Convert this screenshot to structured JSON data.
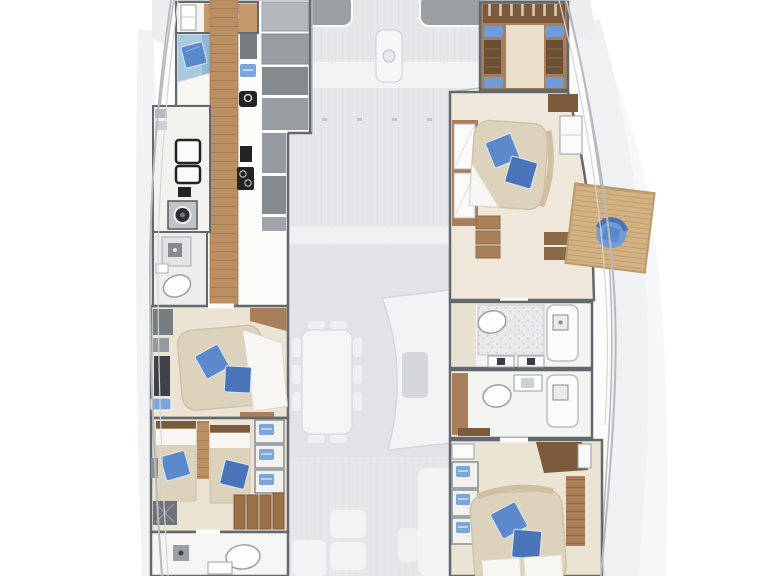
{
  "meta": {
    "subject": "catamaran-yacht-floor-plan",
    "view": "top-down",
    "decks": [
      "lower-deck-accommodation",
      "main-deck-faded-underlay"
    ],
    "visible_text": ""
  },
  "palette": {
    "wall": "#63686c",
    "hull": "#b6babe",
    "wood": "#b98f63",
    "wood_mid": "#a87f58",
    "wood_dark": "#7c5a3c",
    "wood_light": "#c59a6d",
    "platform": "#d2b183",
    "floor": "#ebe3d3",
    "floor_light": "#f0ece4",
    "mattress": "#ddd2bc",
    "linen": "#f7f6f3",
    "bed_blue": "#a9cade",
    "pillow": "#5c88cc",
    "pillow_dark": "#4a74b8",
    "cushion": "#6f9bd9",
    "item_blue": "#7aa6d8",
    "grey_cab": "#94999d",
    "grey_dark": "#787d81",
    "black": "#232323",
    "deck": "#e6e7e9",
    "deck_shape": "#f4f5f6",
    "deck_line": "#d5d7da",
    "hatch": "#8f9499",
    "white": "#ffffff"
  },
  "rooms": {
    "port_hull": [
      {
        "id": "port-fore-bathroom",
        "furniture": [
          "toilet",
          "cabinet",
          "wood-floor"
        ]
      },
      {
        "id": "port-fore-cabin",
        "furniture": [
          "single-bed-lightblue",
          "blue-pillow",
          "white-linen"
        ]
      },
      {
        "id": "port-corridor",
        "furniture": [
          "wood-plank-floor"
        ]
      },
      {
        "id": "port-galley",
        "furniture": [
          "fridge",
          "washing-machine",
          "sink",
          "stove",
          "counters",
          "cabinets",
          "blue-towel"
        ]
      },
      {
        "id": "port-mid-bathroom",
        "furniture": [
          "shower",
          "toilet",
          "washbasin"
        ]
      },
      {
        "id": "port-mid-cabin",
        "furniture": [
          "double-bed",
          "blue-pillow",
          "blue-pillow",
          "desk",
          "blue-washbasin",
          "wood-trim",
          "bench"
        ]
      },
      {
        "id": "port-aft-cabin",
        "furniture": [
          "twin-bed",
          "twin-bed",
          "blue-pillow",
          "blue-pillow",
          "wardrobe-3-shelves",
          "stairs",
          "storage-box"
        ]
      },
      {
        "id": "port-aft-bathroom",
        "furniture": [
          "shower",
          "toilet",
          "washbasin"
        ]
      }
    ],
    "starboard_hull": [
      {
        "id": "starboard-forepeak-cabin",
        "furniture": [
          "berth",
          "headboard-slats",
          "blue-cushions-x4",
          "lockers"
        ]
      },
      {
        "id": "starboard-fore-cabin",
        "furniture": [
          "double-bed",
          "blue-pillow",
          "blue-pillow",
          "mirror-wardrobe",
          "steps",
          "vanity",
          "cabinet"
        ]
      },
      {
        "id": "starboard-balcony-platform",
        "furniture": [
          "fold-out-teak-platform",
          "blue-armchair"
        ]
      },
      {
        "id": "starboard-mid-bathroom",
        "furniture": [
          "toilet",
          "shower-floor",
          "shower-tray",
          "twin-washbasins"
        ]
      },
      {
        "id": "starboard-aft-bathroom",
        "furniture": [
          "toilet",
          "vanity-sink",
          "shower-tray",
          "wood-shelf"
        ]
      },
      {
        "id": "starboard-aft-cabin",
        "furniture": [
          "double-bed",
          "blue-pillow",
          "blue-pillow",
          "wardrobe-3-shelves",
          "wood-cabinet",
          "wood-panel"
        ]
      }
    ],
    "main_deck_faded": [
      {
        "id": "foredeck",
        "furniture": [
          "hatch-left",
          "hatch-right",
          "windlass",
          "crossbeam"
        ]
      },
      {
        "id": "saloon",
        "furniture": [
          "dining-table",
          "chairs",
          "curved-sofa",
          "coffee-table"
        ]
      },
      {
        "id": "cockpit",
        "furniture": [
          "l-bench",
          "seat-squares",
          "bench",
          "table"
        ]
      }
    ]
  }
}
